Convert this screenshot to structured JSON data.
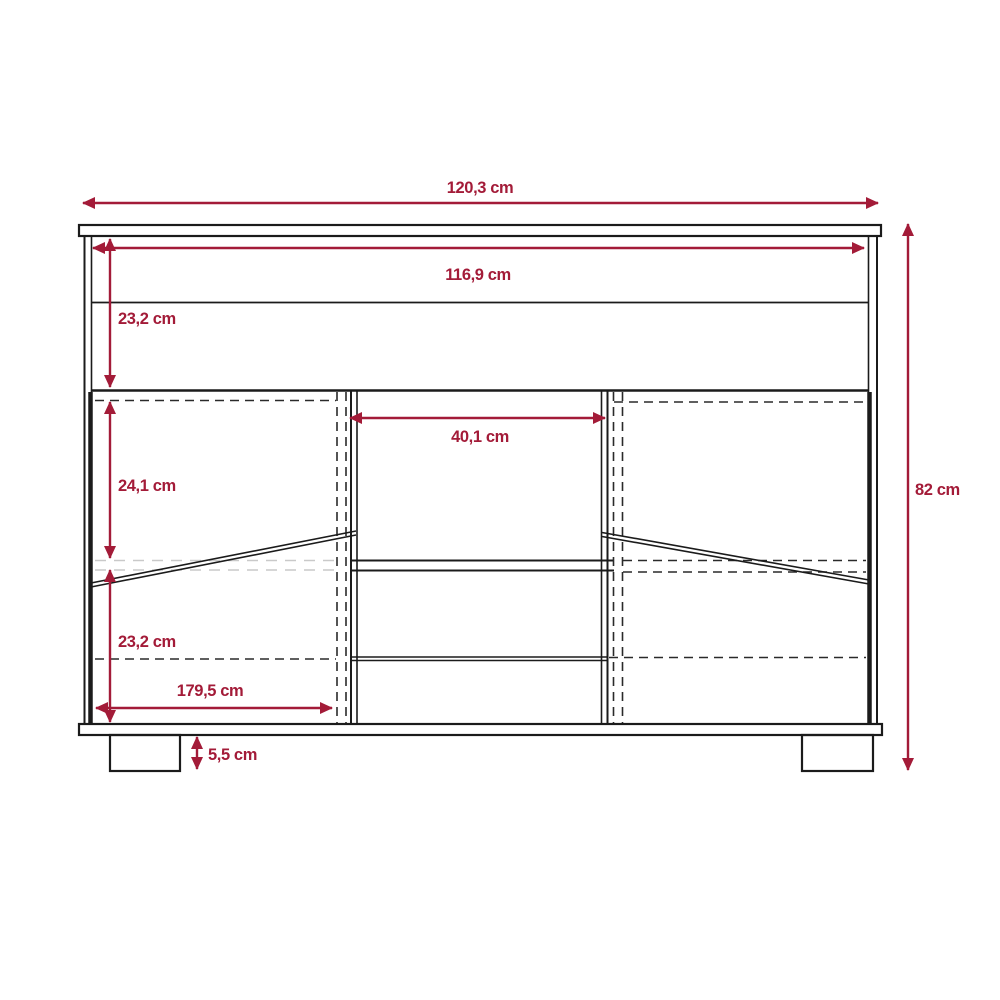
{
  "diagram": {
    "title": "furniture-front-elevation-dimension-drawing",
    "subject": "sideboard / TV stand with two flap doors, open center shelves and two feet",
    "unit": "cm",
    "colors": {
      "dimension_accent": "#A31B38",
      "outline": "#1b1b1b",
      "hidden_shelf_line": "#c9c9c9",
      "background": "#ffffff"
    },
    "dimensions": {
      "overall_width": {
        "label": "120,3 cm",
        "value": 120.3
      },
      "interior_width": {
        "label": "116,9 cm",
        "value": 116.9
      },
      "top_section_height": {
        "label": "23,2 cm",
        "value": 23.2
      },
      "center_opening_width": {
        "label": "40,1 cm",
        "value": 40.1
      },
      "door_upper_height": {
        "label": "24,1 cm",
        "value": 24.1
      },
      "door_lower_height": {
        "label": "23,2 cm",
        "value": 23.2
      },
      "door_span_width": {
        "label": "179,5 cm",
        "value": 179.5
      },
      "foot_height": {
        "label": "5,5 cm",
        "value": 5.5
      },
      "overall_height": {
        "label": "82 cm",
        "value": 82
      }
    }
  }
}
